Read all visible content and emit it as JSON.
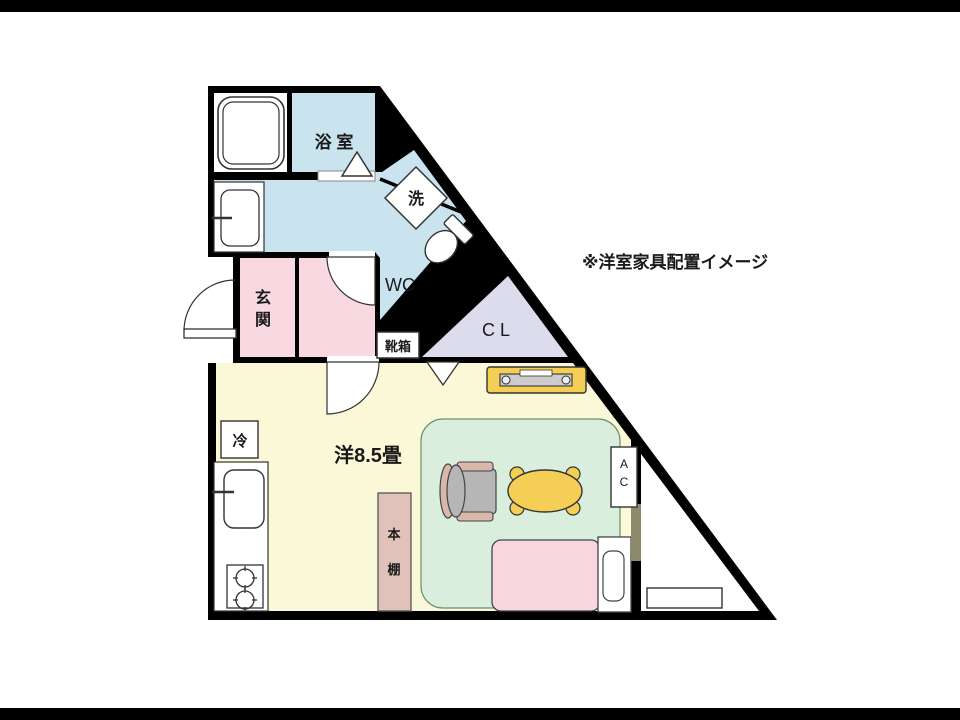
{
  "note": "※洋室家具配置イメージ",
  "rooms": {
    "bathroom": {
      "label": "浴 室"
    },
    "washer": {
      "label": "洗"
    },
    "toilet": {
      "label": "WC"
    },
    "entrance": {
      "chars": [
        "玄",
        "関"
      ]
    },
    "shoebox": {
      "label": "靴箱"
    },
    "closet": {
      "label": "C L"
    },
    "main_room": {
      "label": "洋8.5畳"
    },
    "fridge": {
      "label": "冷"
    },
    "bookshelf": {
      "chars": [
        "本",
        "棚"
      ]
    },
    "aircon": {
      "chars": [
        "A",
        "C"
      ]
    }
  },
  "colors": {
    "wall": "#000000",
    "paper": "#ffffff",
    "wet_area_blue": "#c9e4ee",
    "entrance_pink": "#f8d9e2",
    "closet_lavender": "#dcdcec",
    "room_cream": "#fbf8d8",
    "rug_green": "#d9eedd",
    "furniture_yellow": "#f5cf55",
    "bed_pink": "#f8d6de",
    "shelf_tan": "#e0c2ba",
    "chair_gray": "#b6b6b6",
    "armrest_tan": "#d9b8ab",
    "window_olive": "#8b8b6b"
  }
}
